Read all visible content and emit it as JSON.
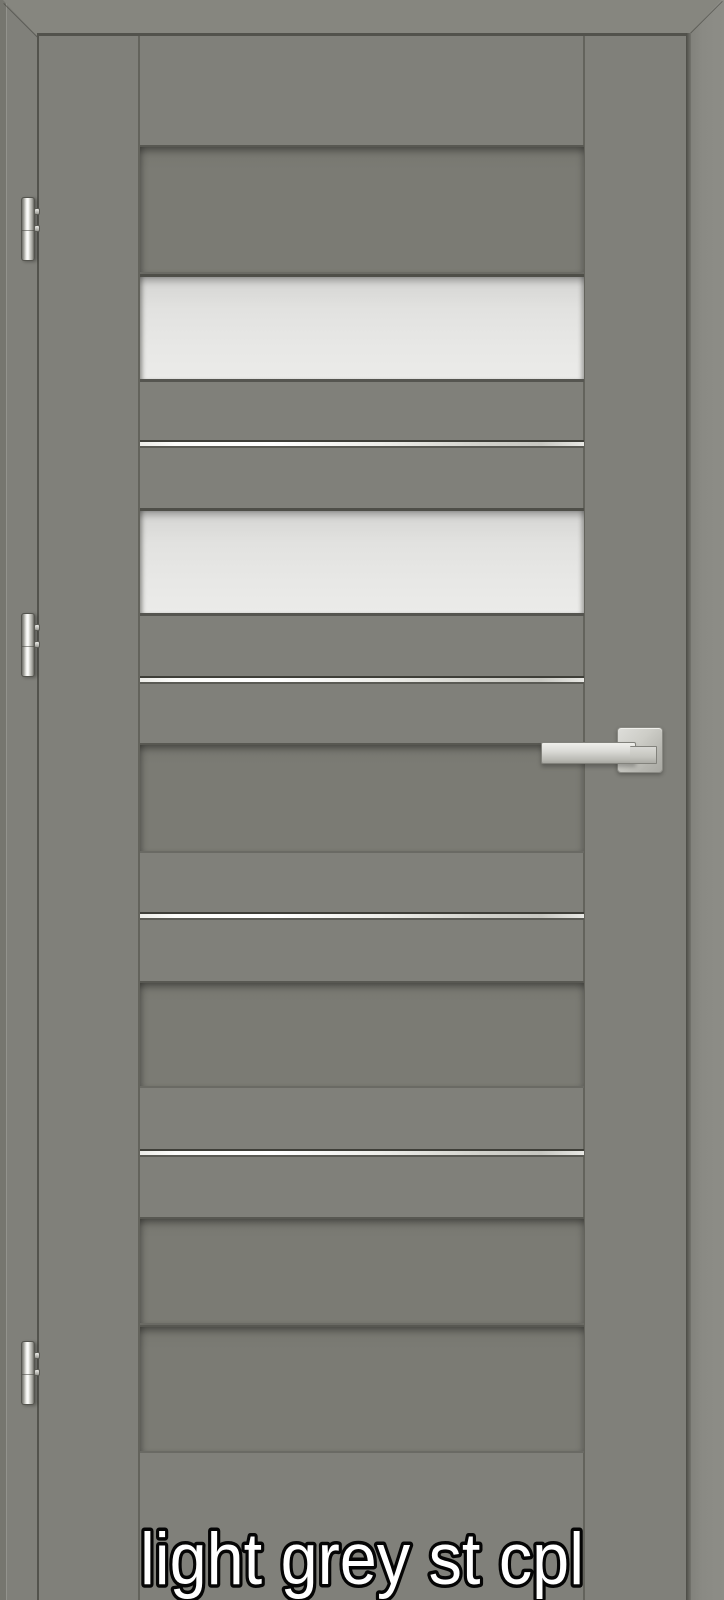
{
  "caption": {
    "text": "light grey st cpl"
  },
  "door": {
    "finish_name": "light grey st cpl",
    "colors": {
      "door_face": "#80807A",
      "recessed_panel": "#7B7B74",
      "frame_top": "#86867F",
      "frame_right": "#8A8A84",
      "glass": "#E8E8E6",
      "aluminium_strip": "#F6F6F4",
      "hardware_chrome": "#D6D6D2",
      "caption_fill": "#FFFFFF",
      "caption_outline": "#000000"
    },
    "structure": {
      "glass_panes": 2,
      "aluminium_strips": 4,
      "recessed_panels": 5,
      "hinge_count": 3
    },
    "bands": [
      {
        "type": "recessed",
        "y": 145,
        "h": 129
      },
      {
        "type": "glass",
        "y": 274,
        "h": 108
      },
      {
        "type": "strip",
        "y": 440,
        "h": 8
      },
      {
        "type": "glass",
        "y": 508,
        "h": 108
      },
      {
        "type": "strip",
        "y": 676,
        "h": 8
      },
      {
        "type": "recessed",
        "y": 743,
        "h": 110
      },
      {
        "type": "strip",
        "y": 912,
        "h": 8
      },
      {
        "type": "recessed",
        "y": 981,
        "h": 107
      },
      {
        "type": "strip",
        "y": 1149,
        "h": 8
      },
      {
        "type": "recessed",
        "y": 1217,
        "h": 108
      },
      {
        "type": "recessed",
        "y": 1325,
        "h": 128
      }
    ],
    "hinges": [
      {
        "y": 197
      },
      {
        "y": 613
      },
      {
        "y": 1341
      }
    ],
    "handle": {
      "rosette": {
        "x": 617,
        "y": 727,
        "w": 46,
        "h": 46
      },
      "lever": {
        "x": 541,
        "y": 742,
        "w": 95,
        "h": 22
      },
      "neck": {
        "dx": 89,
        "dy": 4,
        "w": 27,
        "h": 18
      }
    }
  }
}
